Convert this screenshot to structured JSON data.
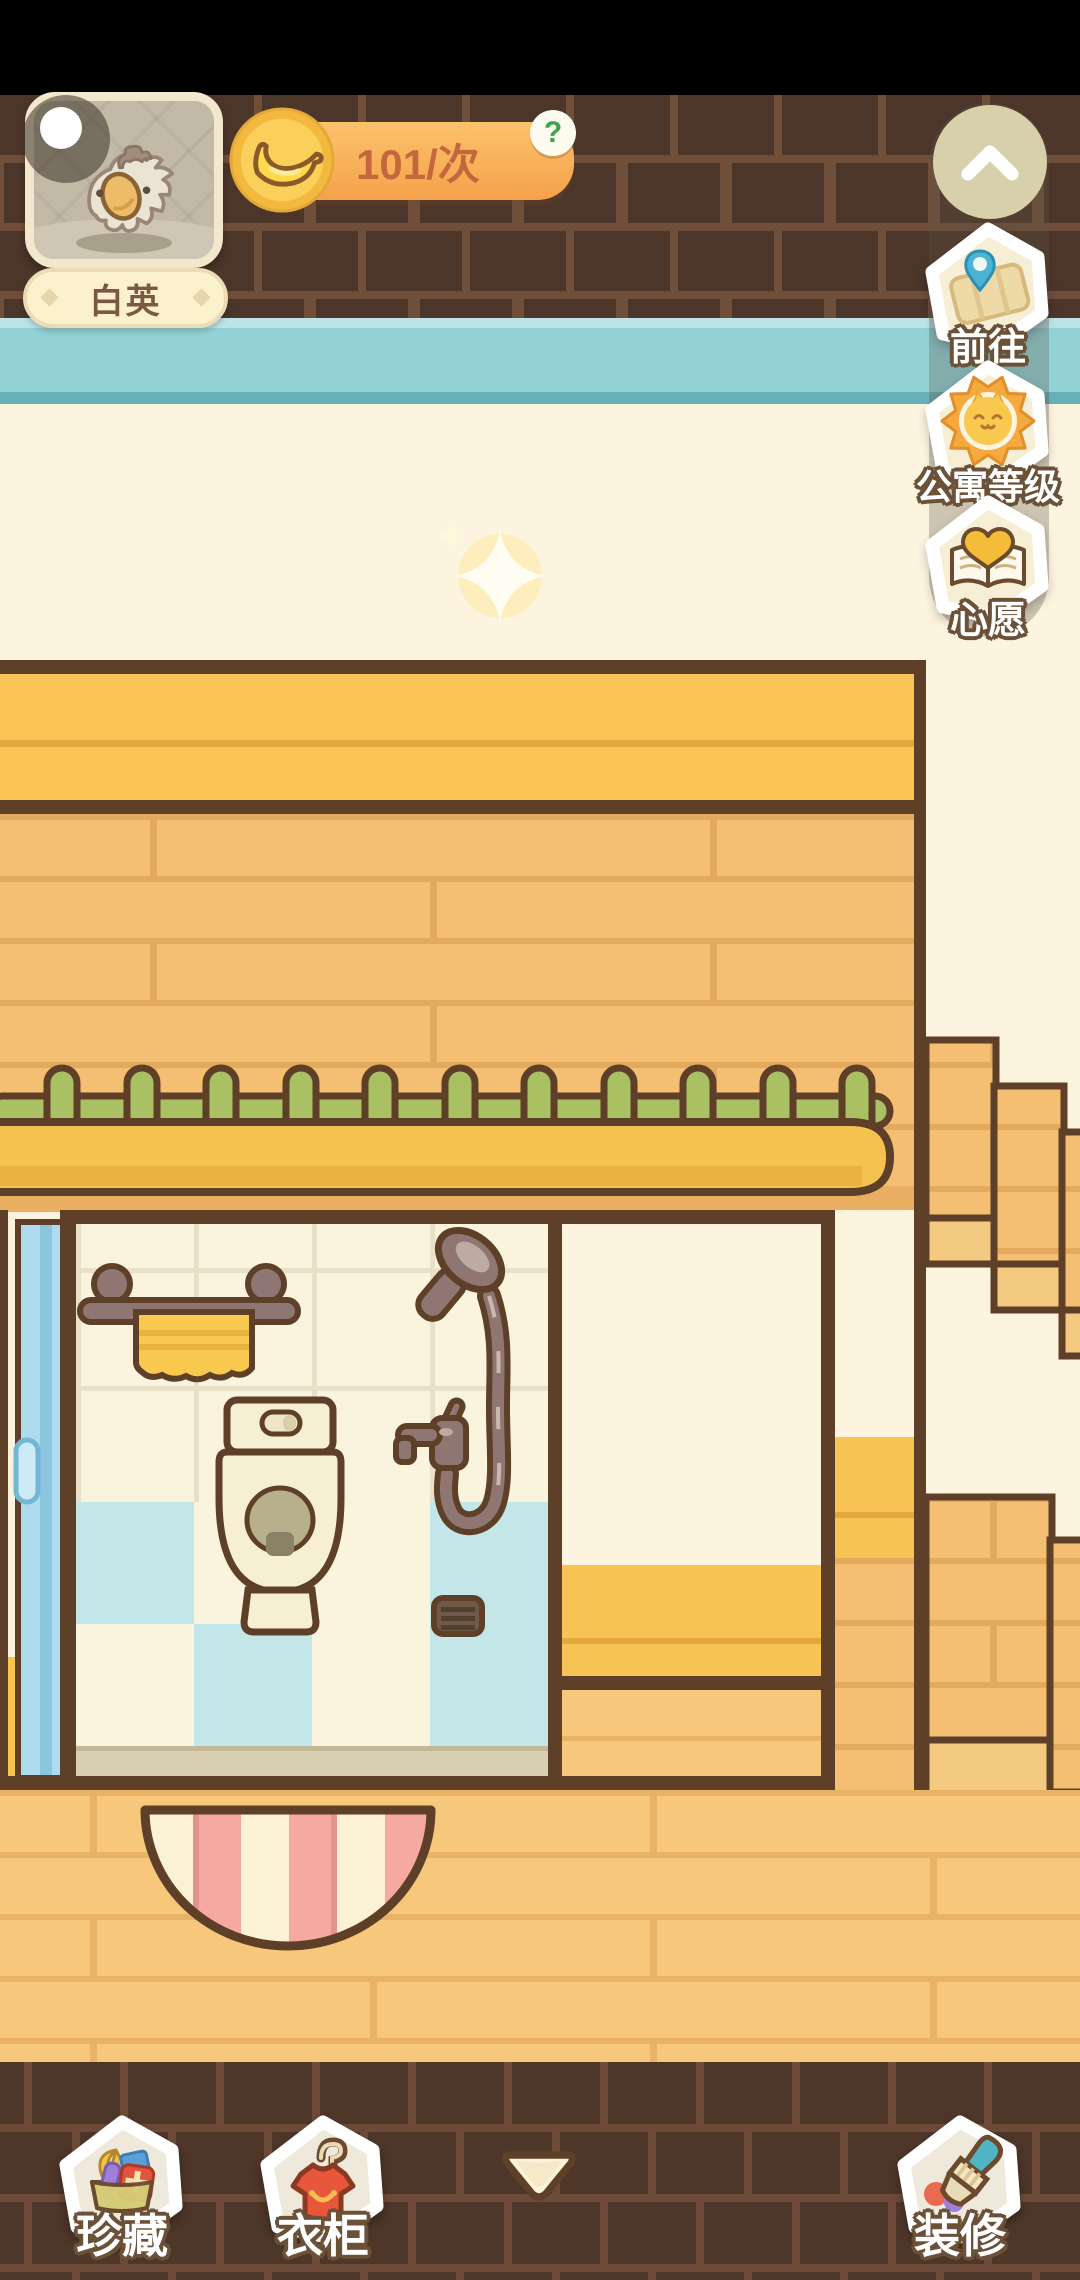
{
  "player": {
    "name": "白英"
  },
  "banana_counter": {
    "value": "101/次",
    "help": "?"
  },
  "side_menu": {
    "items": [
      {
        "id": "goto",
        "label": "前往"
      },
      {
        "id": "apartment-level",
        "label": "公寓等级"
      },
      {
        "id": "wish",
        "label": "心愿"
      }
    ]
  },
  "bottom_menu": {
    "collection_label": "珍藏",
    "wardrobe_label": "衣柜",
    "decorate_label": "装修"
  },
  "icons": {
    "collapse": "chevron-up-icon",
    "goto": "map-pin-icon",
    "apartment_level": "sun-cat-badge-icon",
    "wish": "wish-book-icon",
    "collection": "treasure-box-icon",
    "wardrobe": "shirt-hanger-icon",
    "decorate": "paint-brush-icon",
    "hide_panel": "triangle-down-icon",
    "currency": "banana-coin-icon",
    "help": "question-mark-icon",
    "avatar_status": "moon-indicator-icon"
  },
  "colors": {
    "status_bar": "#000000",
    "brick_dark": "#4c3529",
    "brick_mortar": "#6f4e3a",
    "teal_stripe": "#93d3d7",
    "cream_wall": "#fcf4df",
    "gold_awning": "#f9c455",
    "wood_wall": "#f4bf72",
    "fence_green": "#a9c162",
    "ledge_yellow": "#f5c24f",
    "tile_cream": "#faf3dd",
    "tile_blue": "#c3e6e8",
    "door_blue": "#aedcee",
    "towel_yellow": "#f9c94f",
    "fixture_mauve": "#8f7672",
    "rug_pink": "#f5a9a1",
    "rug_cream": "#fbf1d4",
    "outline_brown": "#5d4027",
    "bar_orange": "#f5a24b",
    "help_green": "#3ca24e",
    "label_outline": "#6b5138"
  }
}
